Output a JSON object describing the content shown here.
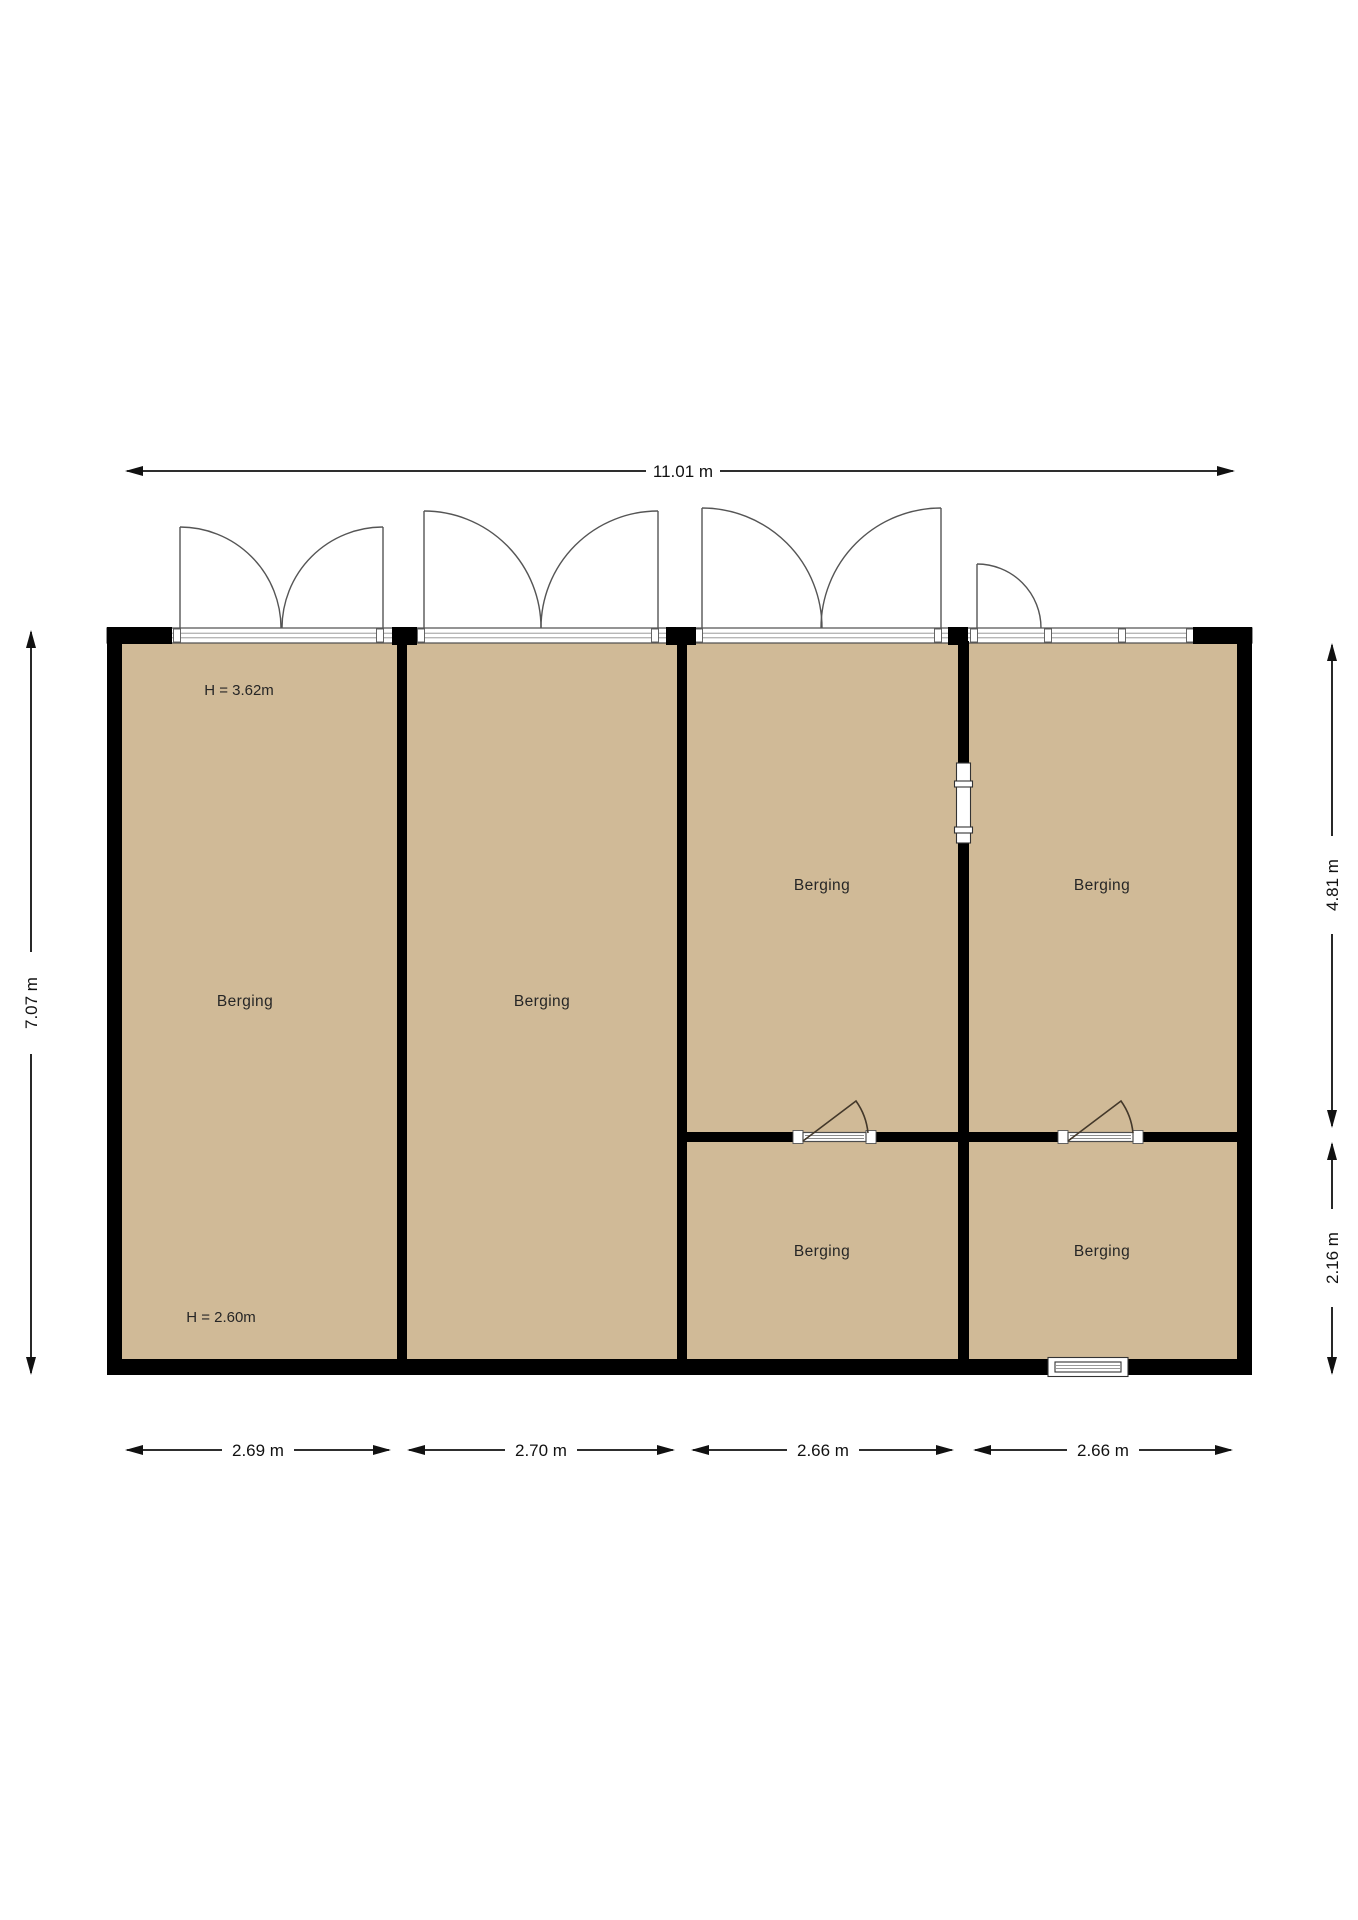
{
  "plan": {
    "title": "Berging floor plan",
    "rooms": [
      {
        "id": "room-1",
        "label": "Berging"
      },
      {
        "id": "room-2",
        "label": "Berging"
      },
      {
        "id": "room-3",
        "label": "Berging"
      },
      {
        "id": "room-4",
        "label": "Berging"
      },
      {
        "id": "room-5",
        "label": "Berging"
      },
      {
        "id": "room-6",
        "label": "Berging"
      }
    ],
    "ceiling_heights": {
      "upper": "H = 3.62m",
      "lower": "H = 2.60m"
    },
    "dimensions": {
      "total_width": "11.01 m",
      "total_height": "7.07 m",
      "right_upper": "4.81 m",
      "right_lower": "2.16 m",
      "bottom_widths": [
        "2.69 m",
        "2.70 m",
        "2.66 m",
        "2.66 m"
      ]
    },
    "colors": {
      "floor": "#d0ba97",
      "wall": "#000000",
      "dimension": "#111111",
      "background": "#ffffff"
    }
  }
}
